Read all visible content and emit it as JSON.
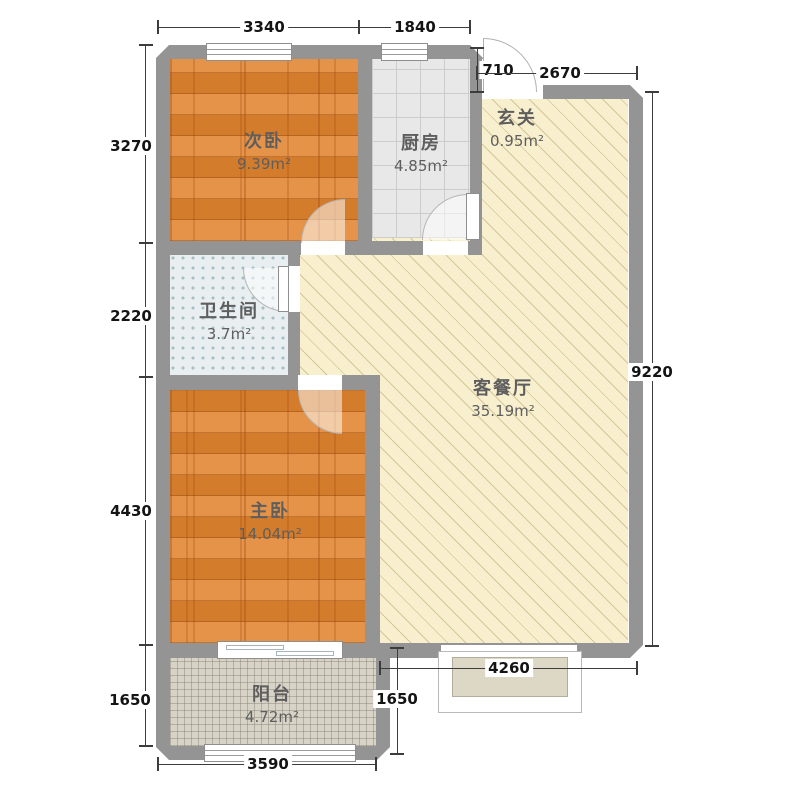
{
  "rooms": {
    "secondary_bedroom": {
      "name": "次卧",
      "area": "9.39m²"
    },
    "kitchen": {
      "name": "厨房",
      "area": "4.85m²"
    },
    "entry": {
      "name": "玄关",
      "area": "0.95m²"
    },
    "bathroom": {
      "name": "卫生间",
      "area": "3.7m²"
    },
    "living_dining": {
      "name": "客餐厅",
      "area": "35.19m²"
    },
    "master_bedroom": {
      "name": "主卧",
      "area": "14.04m²"
    },
    "balcony": {
      "name": "阳台",
      "area": "4.72m²"
    }
  },
  "dimensions": {
    "top_width_left": "3340",
    "top_width_right": "1840",
    "entry_depth": "710",
    "entry_width": "2670",
    "left_height_1": "3270",
    "left_height_2": "2220",
    "left_height_3": "4430",
    "left_height_4": "1650",
    "right_height": "9220",
    "bay_window_width": "4260",
    "balcony_height_right": "1650",
    "bottom_width": "3590"
  },
  "colors": {
    "wall": "#949494",
    "wood_floor": "#e0842f",
    "kitchen_tile": "#e8e8e8",
    "bathroom_tile": "#e9eef0",
    "living_floor": "#f8efce",
    "balcony_tile": "#d7d3c7",
    "dimension_text": "#141414"
  }
}
